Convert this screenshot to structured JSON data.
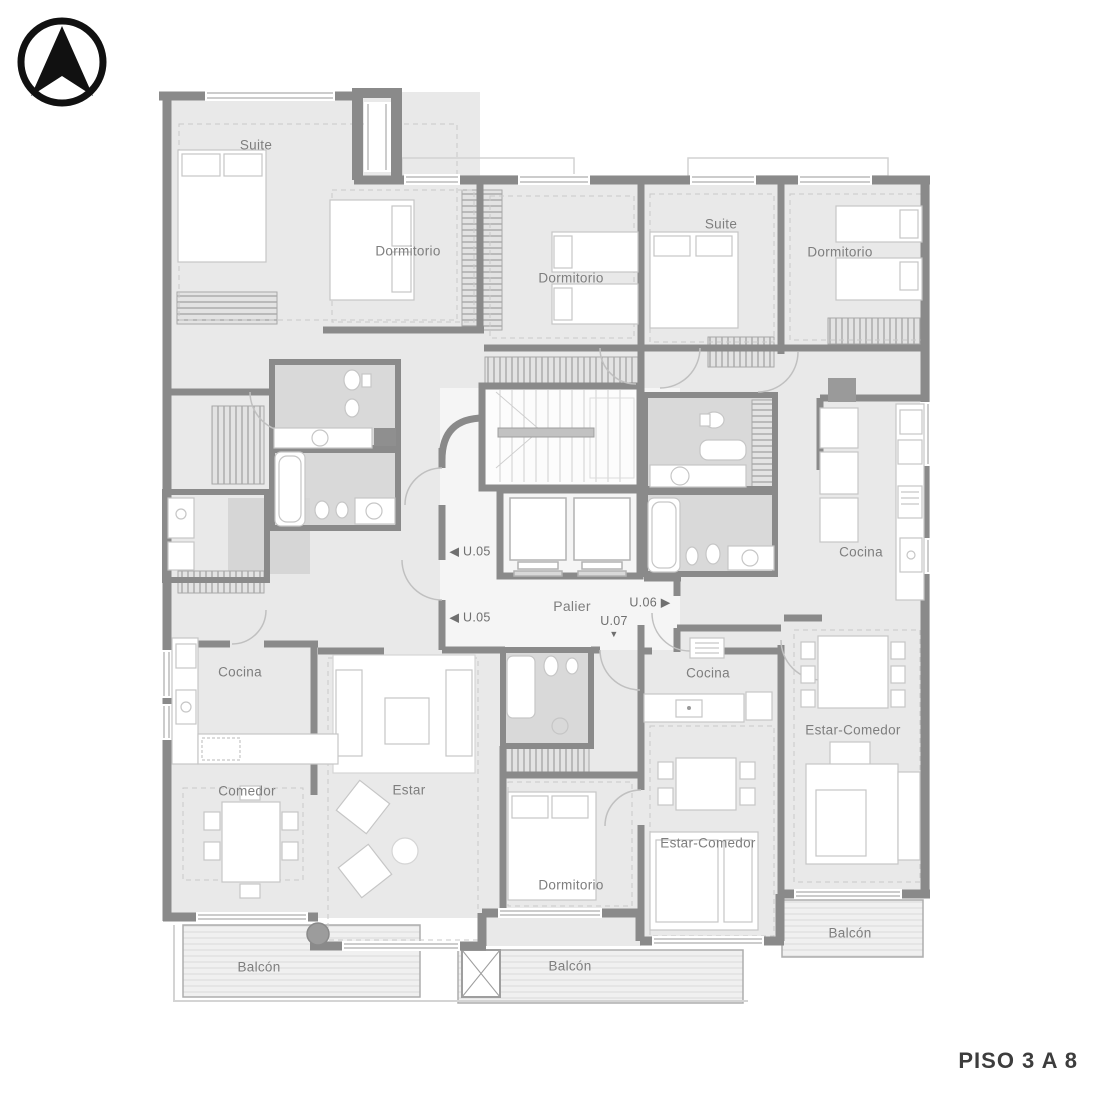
{
  "compass": {
    "icon": "north-arrow"
  },
  "floor_title": "PISO 3 A 8",
  "plan": {
    "rooms": {
      "suite_tl": "Suite",
      "dormitorio_tl": "Dormitorio",
      "dormitorio_tc": "Dormitorio",
      "suite_tc": "Suite",
      "dormitorio_tr": "Dormitorio",
      "cocina_left": "Cocina",
      "comedor_left": "Comedor",
      "estar_left": "Estar",
      "dormitorio_bc": "Dormitorio",
      "cocina_center": "Cocina",
      "estar_comedor_center": "Estar-Comedor",
      "cocina_right": "Cocina",
      "estar_comedor_right": "Estar-Comedor",
      "balcon_left": "Balcón",
      "balcon_center": "Balcón",
      "balcon_right": "Balcón",
      "palier": "Palier"
    },
    "unit_markers": {
      "u05_upper": "◀ U.05",
      "u05_lower": "◀ U.05",
      "u06": "U.06 ▶",
      "u07": "U.07",
      "u07_arrow": "▼"
    }
  },
  "colors": {
    "wall": "#8a8a8a",
    "floor": "#e9e9e9",
    "bath_floor": "#d9d9d9",
    "balcony_floor": "#f0f0f0",
    "label": "#7e7e7e",
    "title": "#3d3d3d",
    "icon": "#111111"
  }
}
